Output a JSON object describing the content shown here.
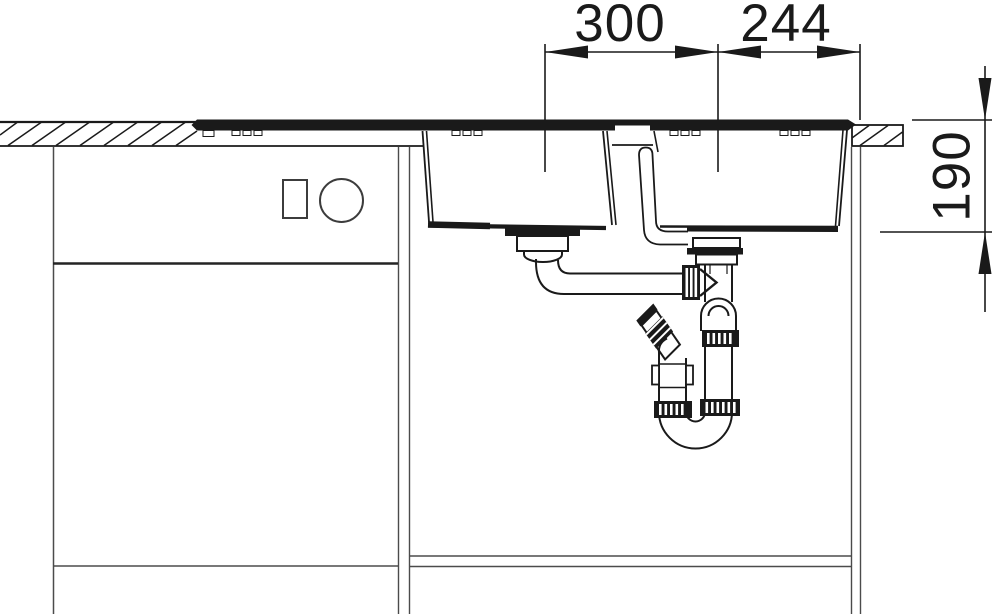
{
  "drawing": {
    "dimensions": {
      "drain_spacing": {
        "label": "300"
      },
      "drain_to_edge": {
        "label": "244"
      },
      "bowl_depth": {
        "label": "190"
      }
    },
    "colors": {
      "line": "#1a1a1a",
      "cabinet_line": "#4b4b4b",
      "background": "#ffffff"
    }
  }
}
